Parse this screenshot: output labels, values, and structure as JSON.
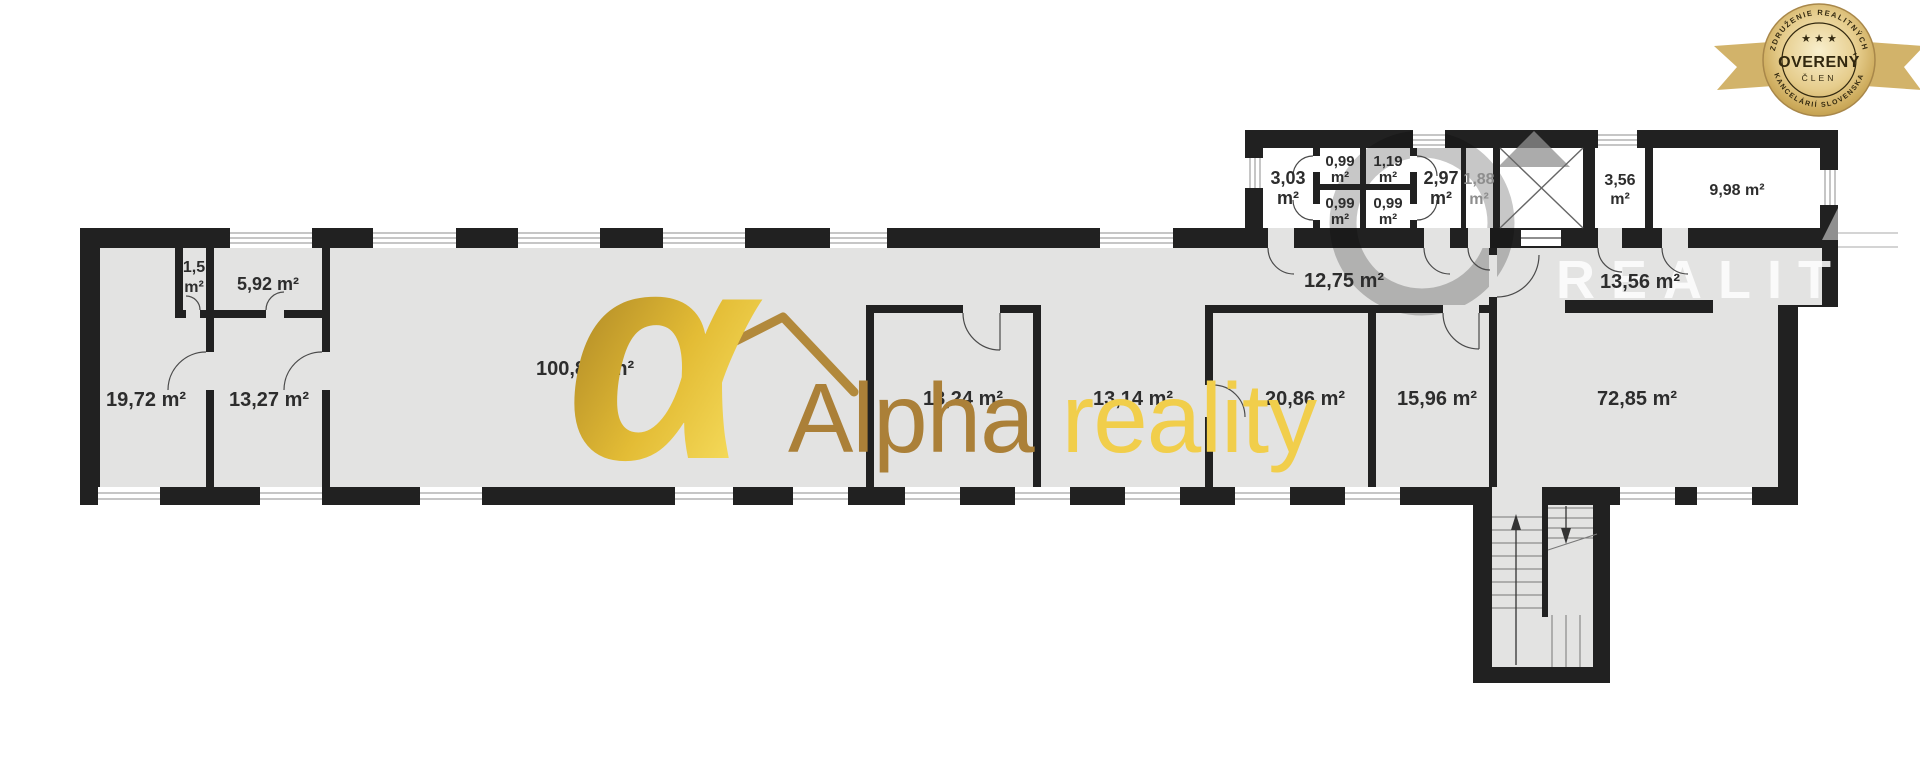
{
  "badge": {
    "arc_top": "ZDRUŽENIE REALITNÝCH",
    "stars": "★ ★ ★",
    "title": "OVERENÝ",
    "subtitle": "ČLEN",
    "arc_bottom": "KANCELÁRIÍ SLOVENSKA",
    "gold_color": "#c9a84c"
  },
  "logo": {
    "alpha_glyph": "α",
    "word1": "Alpha",
    "word2": "reality",
    "word1_color": "#ab8038",
    "word2_color": "#f1ce4b"
  },
  "watermark": {
    "text": "REALIT"
  },
  "plan": {
    "unit": "m²",
    "wall_color": "#212121",
    "room_fill": "#e3e3e2",
    "rooms": [
      {
        "id": "room-1-5",
        "lines": [
          "1,5",
          "m²"
        ]
      },
      {
        "id": "room-5-92",
        "lines": [
          "5,92 m²"
        ]
      },
      {
        "id": "room-19-72",
        "lines": [
          "19,72 m²"
        ]
      },
      {
        "id": "room-13-27",
        "lines": [
          "13,27 m²"
        ]
      },
      {
        "id": "hall-100-8",
        "lines": [
          "100,8",
          "m²"
        ]
      },
      {
        "id": "room-13-24",
        "lines": [
          "13,24 m²"
        ]
      },
      {
        "id": "room-13-14",
        "lines": [
          "13,14 m²"
        ]
      },
      {
        "id": "corridor-12-75",
        "lines": [
          "12,75 m²"
        ]
      },
      {
        "id": "room-20-86",
        "lines": [
          "20,86 m²"
        ]
      },
      {
        "id": "room-15-96",
        "lines": [
          "15,96 m²"
        ]
      },
      {
        "id": "corridor-13-56",
        "lines": [
          "13,56 m²"
        ]
      },
      {
        "id": "room-72-85",
        "lines": [
          "72,85 m²"
        ]
      },
      {
        "id": "room-3-03",
        "lines": [
          "3,03",
          "m²"
        ]
      },
      {
        "id": "wc-0-99-tl",
        "lines": [
          "0,99",
          "m²"
        ]
      },
      {
        "id": "wc-1-19",
        "lines": [
          "1,19",
          "m²"
        ]
      },
      {
        "id": "wc-0-99-bl",
        "lines": [
          "0,99",
          "m²"
        ]
      },
      {
        "id": "wc-0-99-br",
        "lines": [
          "0,99",
          "m²"
        ]
      },
      {
        "id": "room-2-97",
        "lines": [
          "2,97",
          "m²"
        ]
      },
      {
        "id": "room-1-88",
        "lines": [
          "1,88",
          "m²"
        ]
      },
      {
        "id": "room-3-56",
        "lines": [
          "3,56",
          "m²"
        ]
      },
      {
        "id": "room-9-98",
        "lines": [
          "9,98 m²"
        ]
      }
    ]
  }
}
